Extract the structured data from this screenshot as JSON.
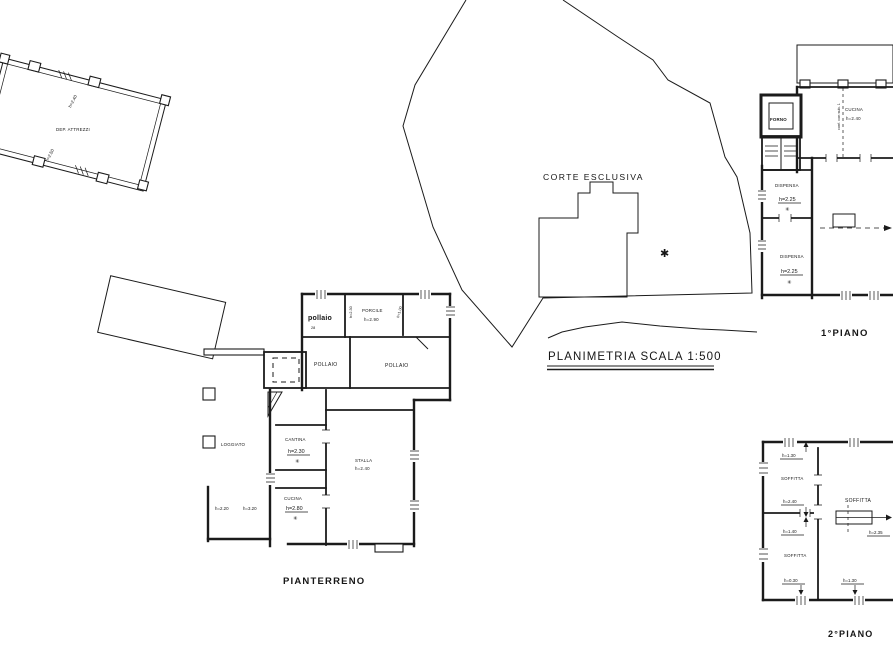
{
  "drawing": {
    "title": "PLANIMETRIA  SCALA  1:500",
    "courtyard_label": "CORTE  ESCLUSIVA",
    "courtyard_marker": "✱"
  },
  "tool_shed": {
    "label": "DEP. ATTREZZI",
    "dim_upper": "h=2.40",
    "dim_lower": "h=2.50"
  },
  "ground_floor": {
    "caption": "PIANTERRENO",
    "pollaio_main": "pollaio",
    "pollaio_main_note": "28",
    "porcile": "PORCILE",
    "porcile_h": "h=2.90",
    "porcile_dim_left": "h=2.30",
    "porcile_dim_right": "h=1.00",
    "pollaio_small": "POLLAIO",
    "pollaio_large": "POLLAIO",
    "loggiato": "LOGGIATO",
    "cantina": "CANTINA",
    "cantina_h": "h=2.30",
    "cantina_marker": "✳",
    "cucina": "CUCINA",
    "cucina_h": "h=2.80",
    "cucina_marker": "✳",
    "stalla": "STALLA",
    "stalla_h": "h=2.40",
    "dim_a": "h=2.20",
    "dim_b": "h=3.20"
  },
  "first_floor": {
    "caption": "1°PIANO",
    "forno": "FORNO",
    "cucina": "CUCINA",
    "cucina_h": "h=2.40",
    "dispensa_1": "DISPENSA",
    "dispensa_1_h": "h=2.25",
    "dispensa_1_marker": "✳",
    "dispensa_2": "DISPENSA",
    "dispensa_2_h": "h=2.25",
    "dispensa_2_marker": "✳",
    "boundary_note": "conf. con sub. 1"
  },
  "second_floor": {
    "caption": "2°PIANO",
    "soffitta_nw": "SOFFITTA",
    "soffitta_nw_top": "h=1.30",
    "soffitta_nw_bottom": "h=2.40",
    "soffitta_sw": "SOFFITTA",
    "soffitta_sw_top": "h=1.40",
    "soffitta_sw_bottom": "h=0.30",
    "soffitta_main": "SOFFITTA",
    "soffitta_main_stair": "h=2.35",
    "soffitta_main_bottom": "h=1.30"
  }
}
